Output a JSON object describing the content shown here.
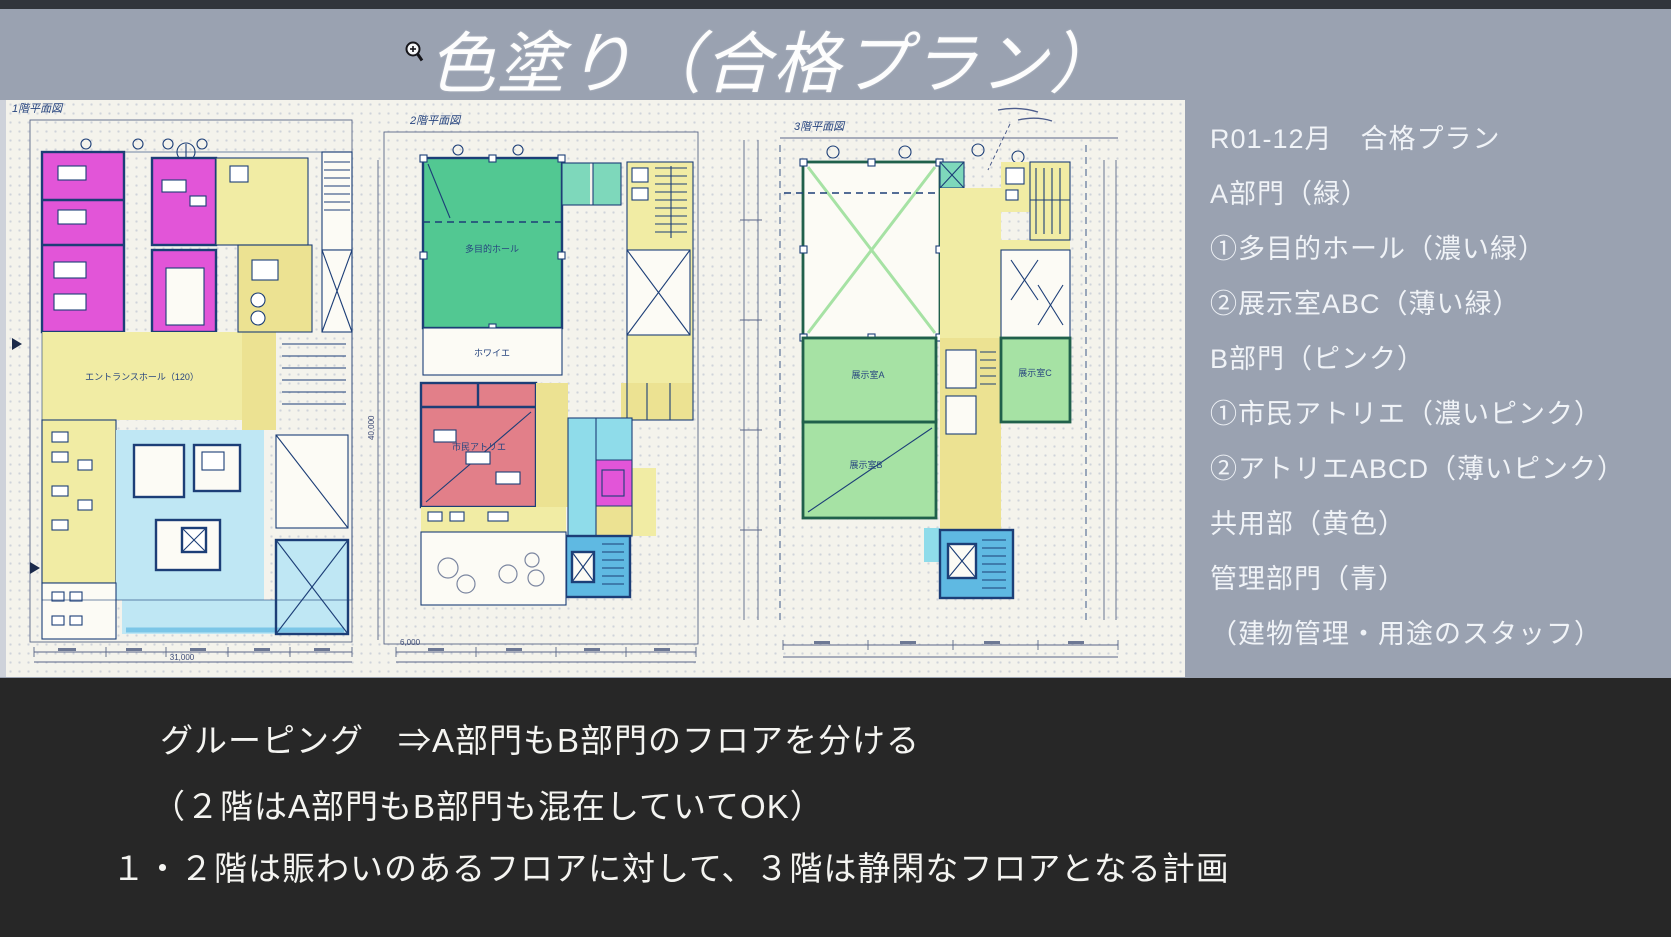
{
  "header": {
    "title": "色塗り（合格プラン）"
  },
  "sidebar": {
    "lines": [
      "R01-12月　合格プラン",
      "A部門（緑）",
      "①多目的ホール（濃い緑）",
      "②展示室ABC（薄い緑）",
      "B部門（ピンク）",
      "①市民アトリエ（濃いピンク）",
      "②アトリエABCD（薄いピンク）",
      "共用部（黄色）",
      "管理部門（青）",
      "（建物管理・用途のスタッフ）"
    ]
  },
  "footer": {
    "lines": [
      "グルーピング　⇒A部門もB部門のフロアを分ける",
      "（２階はA部門もB部門も混在していてOK）",
      "１・２階は賑わいのあるフロアに対して、３階は静閑なフロアとなる計画"
    ]
  },
  "plans": [
    {
      "title": "1階平面図",
      "labels": {
        "hall": "エントランスホール（120）"
      },
      "dims": {
        "total": "31,000"
      }
    },
    {
      "title": "2階平面図",
      "labels": {
        "hall": "多目的ホール",
        "foyer": "ホワイエ",
        "atelier": "市民アトリエ"
      },
      "dims": {
        "left": "40,000",
        "corner": "6,000"
      }
    },
    {
      "title": "3階平面図",
      "labels": {
        "room_a": "展示室A",
        "room_b": "展示室B",
        "room_c": "展示室C"
      }
    }
  ],
  "colors": {
    "slide_bg": "#9aa2b1",
    "band_dark": "#272727",
    "paper": "#f4f3ec",
    "wall": "#1c3e77",
    "wall_green": "#20604b",
    "ink": "#27457f",
    "dark_pink": "#e255d8",
    "red_pink": "#e27f89",
    "dark_green": "#52c892",
    "teal_green": "#7ed8bb",
    "light_green": "#a6e2a4",
    "yellow": "#f1eca4",
    "yellow_strong": "#ece292",
    "blue_light": "#bfe7f4",
    "blue_mid": "#5fb9e2",
    "cyan": "#8fdcea"
  }
}
